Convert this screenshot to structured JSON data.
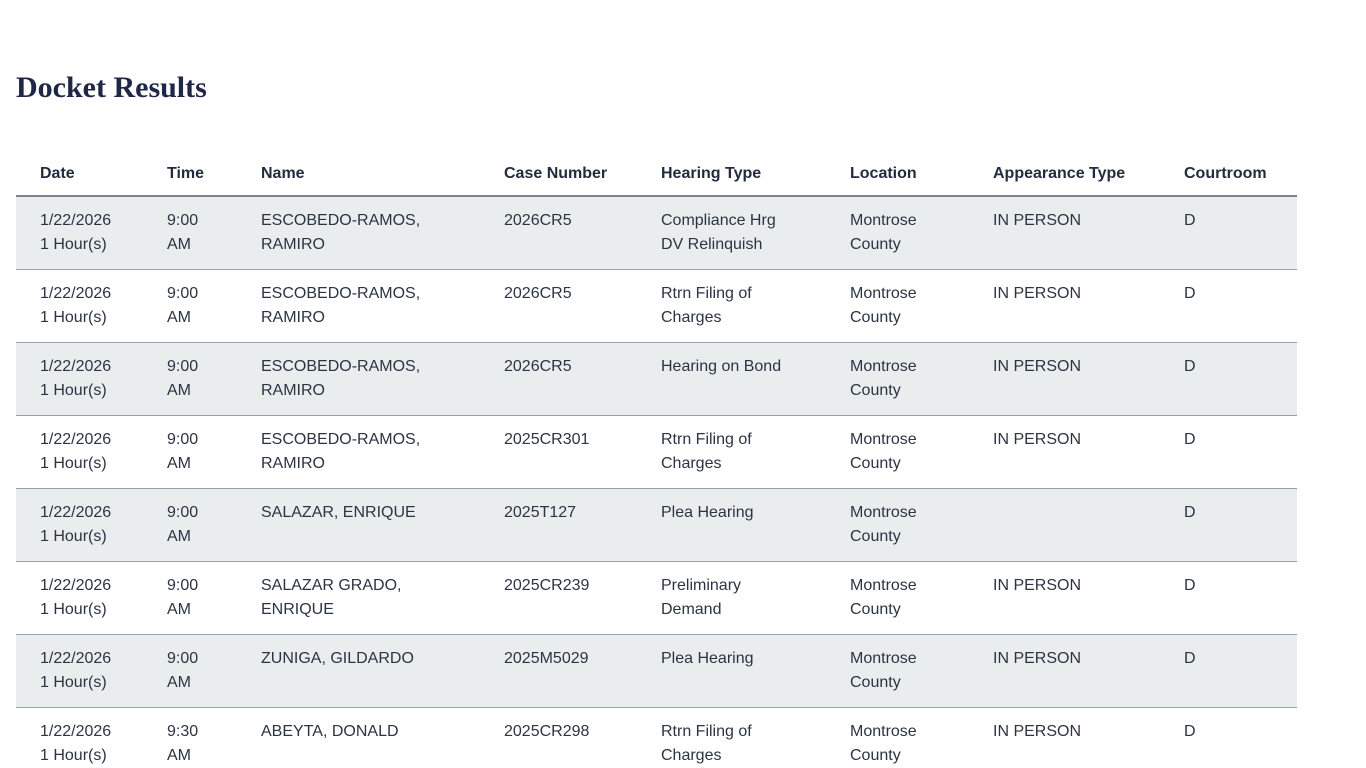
{
  "page": {
    "title": "Docket Results"
  },
  "table": {
    "columns": [
      {
        "key": "date",
        "label": "Date"
      },
      {
        "key": "time",
        "label": "Time"
      },
      {
        "key": "name",
        "label": "Name"
      },
      {
        "key": "case_number",
        "label": "Case Number"
      },
      {
        "key": "hearing_type",
        "label": "Hearing Type"
      },
      {
        "key": "location",
        "label": "Location"
      },
      {
        "key": "appearance_type",
        "label": "Appearance Type"
      },
      {
        "key": "courtroom",
        "label": "Courtroom"
      }
    ],
    "rows": [
      {
        "date": "1/22/2026\n1 Hour(s)",
        "time": "9:00\nAM",
        "name": "ESCOBEDO-RAMOS,\nRAMIRO",
        "case_number": "2026CR5",
        "hearing_type": "Compliance Hrg\nDV Relinquish",
        "location": "Montrose\nCounty",
        "appearance_type": "IN PERSON",
        "courtroom": "D"
      },
      {
        "date": "1/22/2026\n1 Hour(s)",
        "time": "9:00\nAM",
        "name": "ESCOBEDO-RAMOS,\nRAMIRO",
        "case_number": "2026CR5",
        "hearing_type": "Rtrn Filing of\nCharges",
        "location": "Montrose\nCounty",
        "appearance_type": "IN PERSON",
        "courtroom": "D"
      },
      {
        "date": "1/22/2026\n1 Hour(s)",
        "time": "9:00\nAM",
        "name": "ESCOBEDO-RAMOS,\nRAMIRO",
        "case_number": "2026CR5",
        "hearing_type": "Hearing on Bond",
        "location": "Montrose\nCounty",
        "appearance_type": "IN PERSON",
        "courtroom": "D"
      },
      {
        "date": "1/22/2026\n1 Hour(s)",
        "time": "9:00\nAM",
        "name": "ESCOBEDO-RAMOS,\nRAMIRO",
        "case_number": "2025CR301",
        "hearing_type": "Rtrn Filing of\nCharges",
        "location": "Montrose\nCounty",
        "appearance_type": "IN PERSON",
        "courtroom": "D"
      },
      {
        "date": "1/22/2026\n1 Hour(s)",
        "time": "9:00\nAM",
        "name": "SALAZAR, ENRIQUE",
        "case_number": "2025T127",
        "hearing_type": "Plea Hearing",
        "location": "Montrose\nCounty",
        "appearance_type": "",
        "courtroom": "D"
      },
      {
        "date": "1/22/2026\n1 Hour(s)",
        "time": "9:00\nAM",
        "name": "SALAZAR GRADO,\nENRIQUE",
        "case_number": "2025CR239",
        "hearing_type": "Preliminary\nDemand",
        "location": "Montrose\nCounty",
        "appearance_type": "IN PERSON",
        "courtroom": "D"
      },
      {
        "date": "1/22/2026\n1 Hour(s)",
        "time": "9:00\nAM",
        "name": "ZUNIGA, GILDARDO",
        "case_number": "2025M5029",
        "hearing_type": "Plea Hearing",
        "location": "Montrose\nCounty",
        "appearance_type": "IN PERSON",
        "courtroom": "D"
      },
      {
        "date": "1/22/2026\n1 Hour(s)",
        "time": "9:30\nAM",
        "name": "ABEYTA, DONALD",
        "case_number": "2025CR298",
        "hearing_type": "Rtrn Filing of\nCharges",
        "location": "Montrose\nCounty",
        "appearance_type": "IN PERSON",
        "courtroom": "D"
      }
    ]
  }
}
